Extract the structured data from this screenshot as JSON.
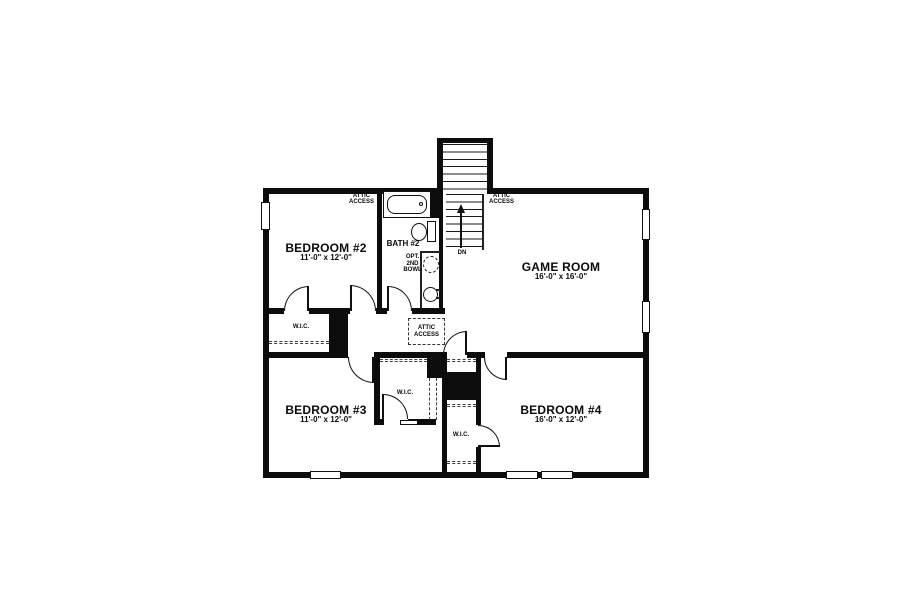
{
  "plan": {
    "rooms": [
      {
        "name": "BEDROOM #2",
        "dims": "11'-0\" x 12'-0\""
      },
      {
        "name": "BATH #2"
      },
      {
        "name": "GAME ROOM",
        "dims": "16'-0\" x 16'-0\""
      },
      {
        "name": "BEDROOM #3",
        "dims": "11'-0\" x 12'-0\""
      },
      {
        "name": "BEDROOM #4",
        "dims": "16'-0\" x 12'-0\""
      }
    ],
    "closet_label": "W.I.C.",
    "attic_access": {
      "line1": "ATTIC",
      "line2": "ACCESS"
    },
    "stairs": {
      "direction_label": "DN"
    },
    "optional_bowl": {
      "line1": "OPT.",
      "line2": "2ND",
      "line3": "BOWL"
    },
    "colors": {
      "wall": "#000000",
      "floor": "#ffffff"
    }
  }
}
